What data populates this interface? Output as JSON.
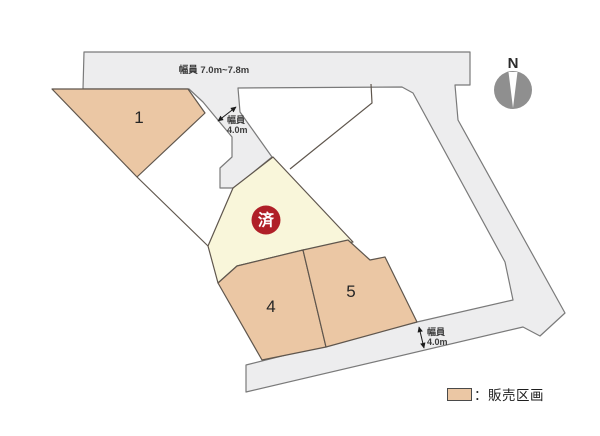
{
  "map": {
    "canvas": {
      "width": 600,
      "height": 436
    },
    "colors": {
      "background": "#ffffff",
      "road_fill": "#ededee",
      "road_stroke": "#7a7a7a",
      "plot_stroke": "#5f564d",
      "sale_plot_fill": "#ebc7a4",
      "sold_plot_fill": "#f9f6da",
      "sold_badge_fill": "#b01f27",
      "sold_badge_text": "#ffffff",
      "label_color": "#3c3c3c",
      "plot_number_color": "#262626",
      "compass_fill": "#8f8f8f"
    },
    "roads": {
      "name": "road-network",
      "points": [
        [
          84,
          52
        ],
        [
          470,
          52
        ],
        [
          470,
          85
        ],
        [
          455,
          85
        ],
        [
          458,
          120
        ],
        [
          565,
          313
        ],
        [
          540,
          336
        ],
        [
          523,
          327
        ],
        [
          246,
          392
        ],
        [
          246,
          365
        ],
        [
          417,
          322
        ],
        [
          513,
          300
        ],
        [
          505,
          262
        ],
        [
          413,
          93
        ],
        [
          402,
          87
        ],
        [
          238,
          88
        ],
        [
          240,
          112
        ],
        [
          272,
          157
        ],
        [
          234,
          188
        ],
        [
          220,
          188
        ],
        [
          220,
          168
        ],
        [
          232,
          157
        ],
        [
          232,
          137
        ],
        [
          203,
          102
        ],
        [
          189,
          89
        ],
        [
          83,
          89
        ]
      ]
    },
    "plots": [
      {
        "name": "plot-1",
        "label": "1",
        "type": "sale",
        "points": [
          [
            52,
            89
          ],
          [
            188,
            89
          ],
          [
            205,
            113
          ],
          [
            137,
            177
          ]
        ],
        "label_x": 139,
        "label_y": 123
      },
      {
        "name": "plot-sold",
        "label": "",
        "type": "sold",
        "points": [
          [
            208,
            246
          ],
          [
            233,
            188
          ],
          [
            273,
            157
          ],
          [
            353,
            242
          ],
          [
            303,
            250
          ],
          [
            237,
            266
          ],
          [
            218,
            283
          ]
        ]
      },
      {
        "name": "plot-4",
        "label": "4",
        "type": "sale",
        "points": [
          [
            237,
            266
          ],
          [
            303,
            250
          ],
          [
            326,
            347
          ],
          [
            262,
            360
          ],
          [
            218,
            283
          ]
        ],
        "label_x": 271,
        "label_y": 312
      },
      {
        "name": "plot-5",
        "label": "5",
        "type": "sale",
        "points": [
          [
            303,
            250
          ],
          [
            348,
            240
          ],
          [
            370,
            260
          ],
          [
            385,
            257
          ],
          [
            417,
            322
          ],
          [
            326,
            347
          ]
        ],
        "label_x": 351,
        "label_y": 297
      }
    ],
    "boundary_lines": [
      {
        "name": "parcel-boundary-left",
        "points": [
          [
            137,
            177
          ],
          [
            208,
            246
          ]
        ]
      },
      {
        "name": "white-plot-divider",
        "points": [
          [
            371,
            84
          ],
          [
            372,
            103
          ],
          [
            290,
            169
          ]
        ]
      }
    ],
    "dimension_labels": [
      {
        "name": "road-width-top",
        "lines": [
          "幅員 7.0m~7.8m"
        ],
        "x": 214,
        "y": 73,
        "size": 9.5,
        "anchor": "middle",
        "line_height": 10
      },
      {
        "name": "road-width-4m-upper",
        "lines": [
          "幅員",
          "4.0m"
        ],
        "x": 227,
        "y": 123,
        "size": 9,
        "anchor": "start",
        "line_height": 10
      },
      {
        "name": "road-width-4m-lower",
        "lines": [
          "幅員",
          "4.0m"
        ],
        "x": 427,
        "y": 335,
        "size": 9,
        "anchor": "start",
        "line_height": 10
      }
    ],
    "arrows": [
      {
        "name": "width-arrow-upper",
        "x1": 218,
        "y1": 121,
        "x2": 236,
        "y2": 107
      },
      {
        "name": "width-arrow-lower",
        "x1": 419,
        "y1": 327,
        "x2": 424,
        "y2": 348
      }
    ],
    "sold_badge": {
      "text": "済",
      "cx": 266,
      "cy": 220,
      "r": 14.5
    },
    "compass": {
      "label": "N",
      "cx": 513,
      "cy": 90,
      "r": 19,
      "label_x": 513,
      "label_y": 68
    },
    "legend": {
      "label": "：販売区画"
    }
  }
}
